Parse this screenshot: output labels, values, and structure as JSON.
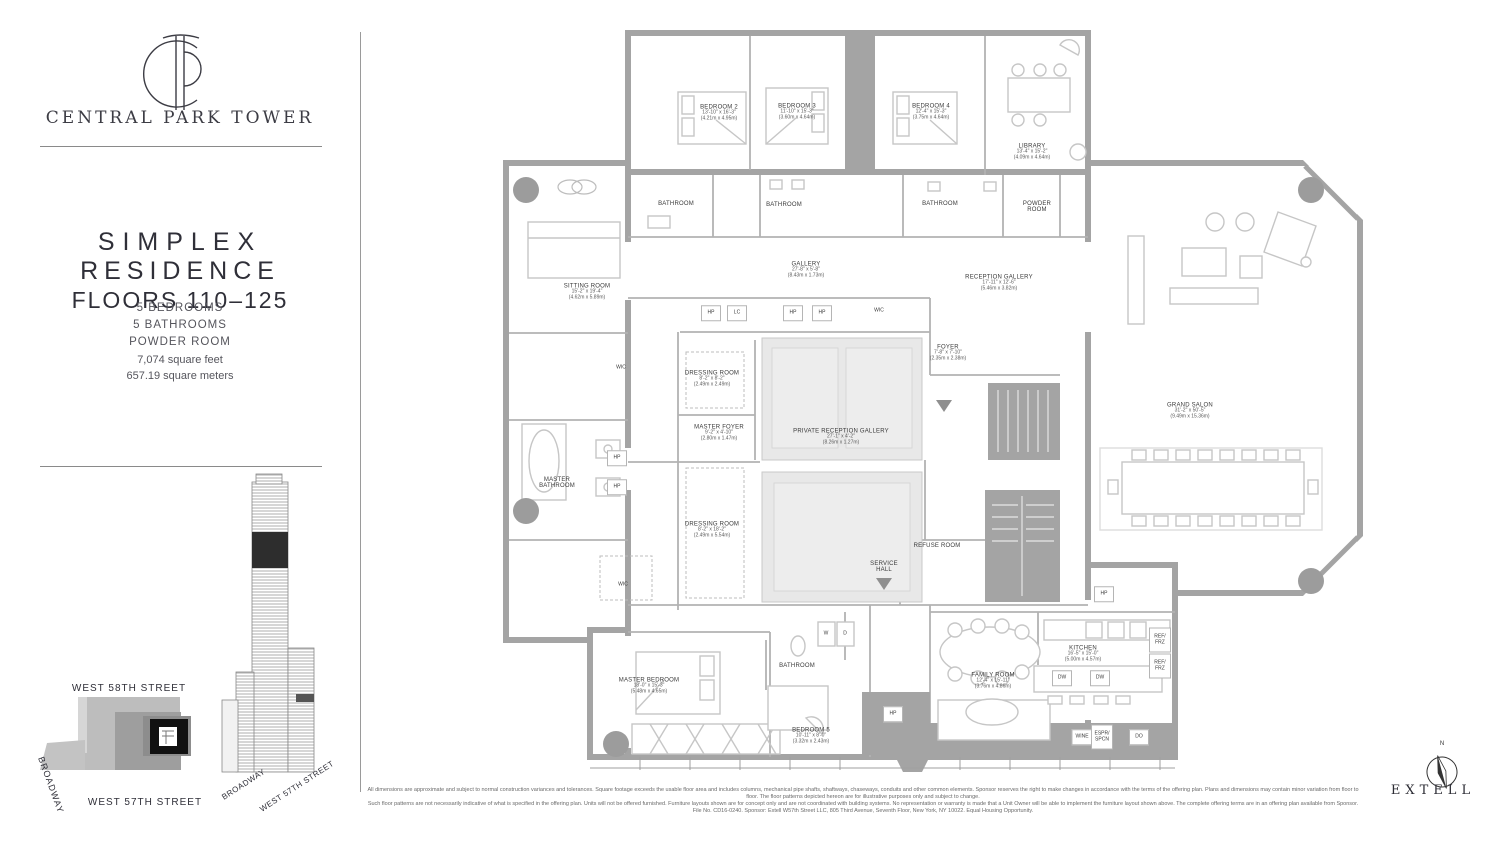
{
  "sidebar": {
    "brand": "CENTRAL PARK TOWER",
    "title_line1": "SIMPLEX",
    "title_line2": "RESIDENCE",
    "title_line3": "FLOORS 110–125",
    "feature1": "5 BEDROOMS",
    "feature2": "5 BATHROOMS",
    "feature3": "POWDER ROOM",
    "area_ft": "7,074 square feet",
    "area_m": "657.19 square meters",
    "site_map": {
      "street_top": "WEST 58TH STREET",
      "street_left": "BROADWAY",
      "street_bottom": "WEST 57TH STREET"
    },
    "tower": {
      "label_left": "BROADWAY",
      "label_right": "WEST 57TH STREET"
    }
  },
  "plan": {
    "rooms": {
      "bedroom2": {
        "name": "BEDROOM 2",
        "ft": "13'-10\" x 16'-3\"",
        "m": "(4.21m x 4.95m)"
      },
      "bedroom3": {
        "name": "BEDROOM 3",
        "ft": "11'-10\" x 15'-3\"",
        "m": "(3.60m x 4.64m)"
      },
      "bedroom4": {
        "name": "BEDROOM 4",
        "ft": "12'-4\" x 15'-3\"",
        "m": "(3.75m x 4.64m)"
      },
      "library": {
        "name": "LIBRARY",
        "ft": "13'-4\" x 15'-2\"",
        "m": "(4.09m x 4.64m)"
      },
      "sitting": {
        "name": "SITTING ROOM",
        "ft": "15'-2\" x 19'-4\"",
        "m": "(4.62m x 5.89m)"
      },
      "gallery": {
        "name": "GALLERY",
        "ft": "27'-8\" x 5'-8\"",
        "m": "(8.43m x 1.73m)"
      },
      "reception": {
        "name": "RECEPTION GALLERY",
        "ft": "17'-11\" x 12'-6\"",
        "m": "(5.46m x 3.82m)"
      },
      "foyer": {
        "name": "FOYER",
        "ft": "7'-8\" x 7'-10\"",
        "m": "(2.35m x 2.38m)"
      },
      "grand_salon": {
        "name": "GRAND SALON",
        "ft": "31'-2\" x 50'-5\"",
        "m": "(9.49m x 15.36m)"
      },
      "dressing1": {
        "name": "DRESSING ROOM",
        "ft": "8'-2\" x 8'-2\"",
        "m": "(2.49m x 2.49m)"
      },
      "master_foyer": {
        "name": "MASTER FOYER",
        "ft": "9'-2\" x 4'-10\"",
        "m": "(2.80m x 1.47m)"
      },
      "private_reception": {
        "name": "PRIVATE RECEPTION GALLERY",
        "ft": "27'-1\" x 4'-2\"",
        "m": "(8.26m x 1.27m)"
      },
      "dressing2": {
        "name": "DRESSING ROOM",
        "ft": "8'-2\" x 18'-2\"",
        "m": "(2.49m x 5.54m)"
      },
      "master_bathroom": {
        "name": "MASTER BATHROOM"
      },
      "master_bedroom": {
        "name": "MASTER BEDROOM",
        "ft": "18'-0\" x 15'-3\"",
        "m": "(5.48m x 4.65m)"
      },
      "bedroom5": {
        "name": "BEDROOM 5",
        "ft": "10'-11\" x 8'-0\"",
        "m": "(3.32m x 2.43m)"
      },
      "family_room": {
        "name": "FAMILY ROOM",
        "ft": "12'-4\" x 15'-11\"",
        "m": "(3.76m x 4.86m)"
      },
      "kitchen": {
        "name": "KITCHEN",
        "ft": "16'-5\" x 15'-0\"",
        "m": "(5.00m x 4.57m)"
      },
      "service_hall": {
        "name": "SERVICE HALL"
      },
      "refuse_room": {
        "name": "REFUSE ROOM"
      },
      "powder_room": {
        "name": "POWDER ROOM"
      },
      "bathroom": {
        "name": "BATHROOM"
      }
    },
    "fixtures": {
      "hp": "HP",
      "lc": "LC",
      "wic": "WIC",
      "w": "W",
      "d": "D",
      "dw": "DW",
      "ref_frz": "REF/ FRZ",
      "wine": "WINE",
      "espr_spcn": "ESPR/ SPCN",
      "do": "DO"
    },
    "colors": {
      "wall": "#a4a4a4",
      "furniture": "#c6c6c6",
      "rug": "#e8e8e8"
    }
  },
  "footer": {
    "disclaimer_line1": "All dimensions are approximate and subject to normal construction variances and tolerances. Square footage exceeds the usable floor area and includes columns, mechanical pipe shafts, shaftways, chaseways, conduits and other common elements. Sponsor reserves the right to make changes in accordance with the terms of the offering plan. Plans and dimensions may contain minor variation from floor to floor. The floor patterns depicted hereon are for illustrative purposes only and subject to change.",
    "disclaimer_line2": "Such floor patterns are not necessarily indicative of what is specified in the offering plan. Units will not be offered furnished. Furniture layouts shown are for concept only and are not coordinated with building systems. No representation or warranty is made that a Unit Owner will be able to implement the furniture layout shown above. The complete offering terms are in an offering plan available from Sponsor. File No. CD16-0240. Sponsor: Extell W57th Street LLC, 805 Third Avenue, Seventh Floor, New York, NY 10022. Equal Housing Opportunity.",
    "brand": "EXTELL",
    "compass": "N"
  }
}
